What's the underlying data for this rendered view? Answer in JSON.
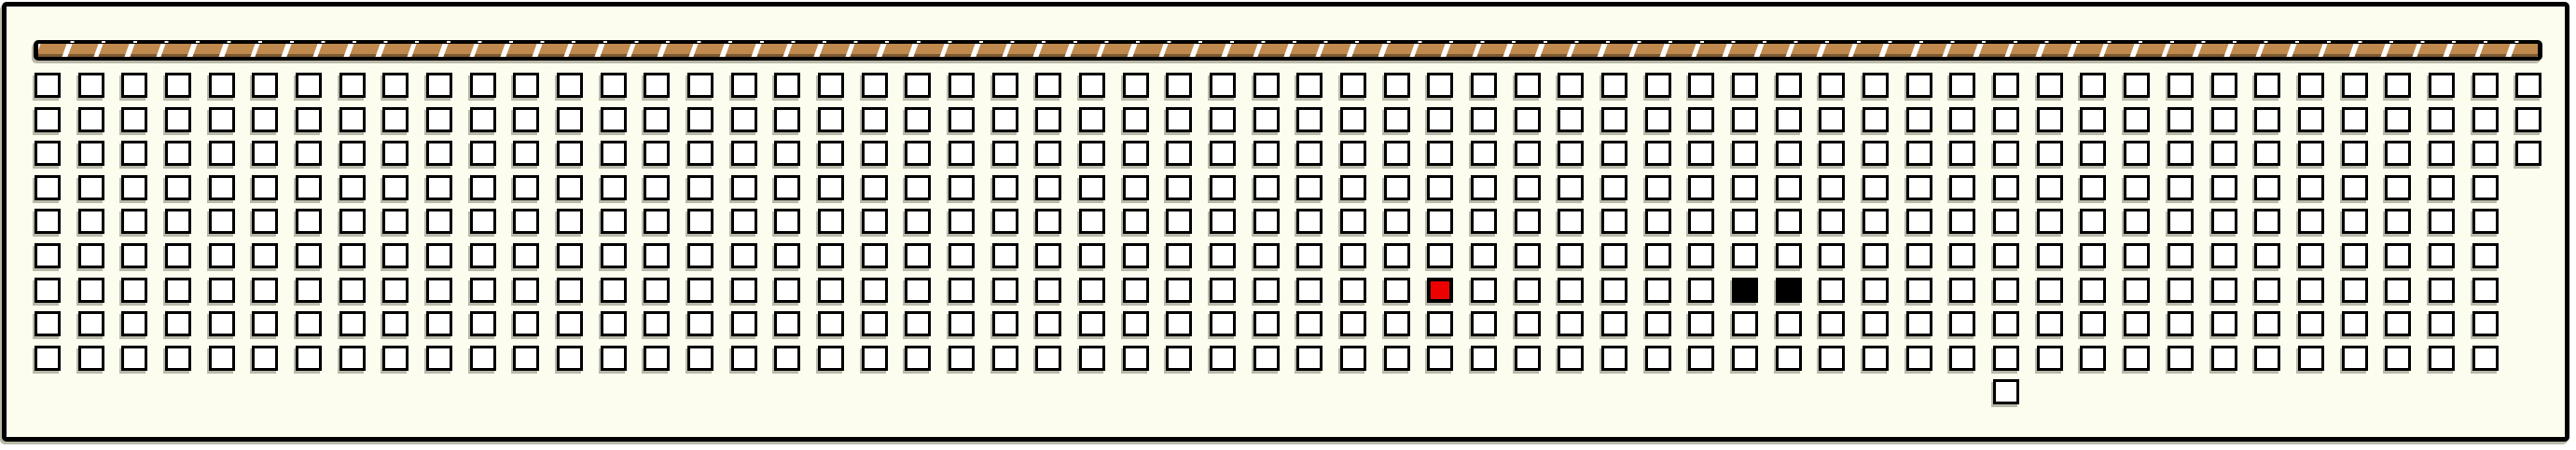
{
  "panel": {
    "background_color": "#fcfcef",
    "outline_color": "#000000",
    "shadow_color": "#b9b9aa"
  },
  "stage_bar": {
    "segment_count": 80,
    "plank_color": "#c0894e",
    "plank_edge_color": "#7d5a31",
    "band_color": "#000000",
    "slash_gap_color": "#ffffff"
  },
  "seat_grid": {
    "columns": 58,
    "seat_fill_color": "#ffffff",
    "seat_outline_color": "#000000",
    "selected_color": "#ee0000",
    "occupied_color": "#000000",
    "rows": [
      {
        "row": 0,
        "col_from": 0,
        "col_to": 57
      },
      {
        "row": 1,
        "col_from": 0,
        "col_to": 57
      },
      {
        "row": 2,
        "col_from": 0,
        "col_to": 57
      },
      {
        "row": 3,
        "col_from": 0,
        "col_to": 56
      },
      {
        "row": 4,
        "col_from": 0,
        "col_to": 56
      },
      {
        "row": 5,
        "col_from": 0,
        "col_to": 56
      },
      {
        "row": 6,
        "col_from": 0,
        "col_to": 56
      },
      {
        "row": 7,
        "col_from": 0,
        "col_to": 56
      },
      {
        "row": 8,
        "col_from": 0,
        "col_to": 56
      },
      {
        "row": 9,
        "col_from": 45,
        "col_to": 45
      }
    ],
    "special_seats": [
      {
        "row": 6,
        "col": 32,
        "state": "red"
      },
      {
        "row": 6,
        "col": 39,
        "state": "black"
      },
      {
        "row": 6,
        "col": 40,
        "state": "black"
      }
    ]
  }
}
